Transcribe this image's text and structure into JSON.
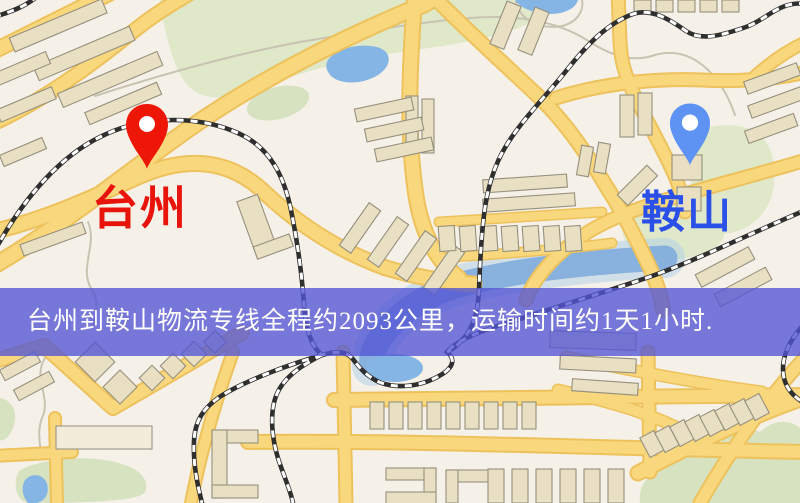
{
  "markers": {
    "origin": {
      "label": "台州",
      "pin_color": "#ee1606",
      "label_color": "#e8140b"
    },
    "destination": {
      "label": "鞍山",
      "pin_color": "#5e93f4",
      "label_color": "#2a50e8"
    }
  },
  "banner": {
    "text": "台州到鞍山物流专线全程约2093公里，运输时间约1天1小时.",
    "background_color": "#5254d5",
    "text_color": "#ffffff"
  },
  "map_colors": {
    "background": "#f6f1e8",
    "road_fill": "#f9d77d",
    "road_border": "#edc25c",
    "building": "#e9dfc2",
    "building_border": "#95907e",
    "park": "#dfe8c8",
    "water": "#85b5e5",
    "railway": "#2f2f2f"
  }
}
